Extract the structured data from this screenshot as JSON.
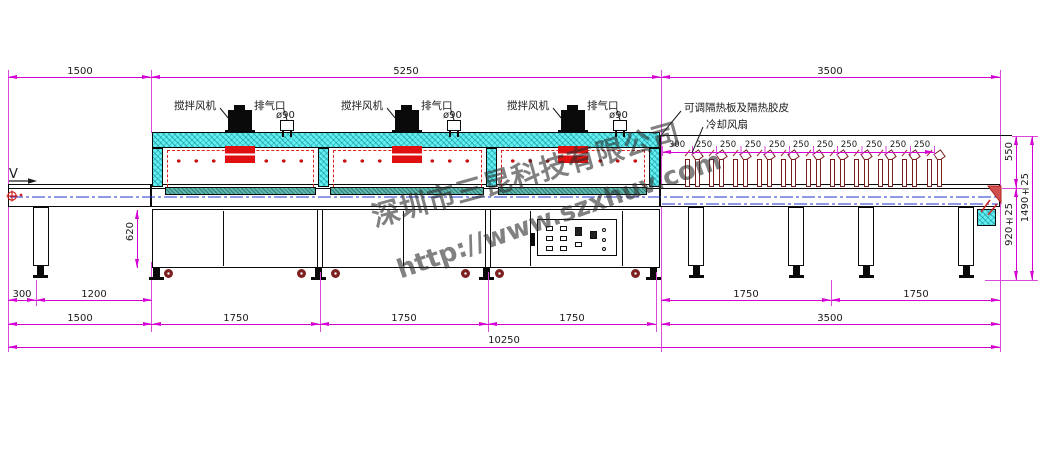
{
  "watermark": {
    "company": "深圳市三昆科技有限公司",
    "url": "http://www.szxhuv.com"
  },
  "labels": {
    "mixing_fan": "搅拌风机",
    "exhaust_port": "排气口",
    "exhaust_diameter": "ø90",
    "insulation": "可调隔热板及隔热胶皮",
    "cooling_fan": "冷却风扇",
    "direction": "V"
  },
  "dimensions": {
    "top": {
      "infeed": "1500",
      "oven": "5250",
      "cooling": "3500"
    },
    "fan_pitch": [
      "300",
      "250",
      "250",
      "250",
      "250",
      "250",
      "250",
      "250",
      "250",
      "250",
      "250"
    ],
    "right": {
      "fan_height": "550",
      "belt_height": "920±25",
      "total_height": "1490±25"
    },
    "left_stand_height": "620",
    "bottom_row1": {
      "left1": "300",
      "left2": "1200",
      "right1": "1750",
      "right2": "1750"
    },
    "bottom_row2": {
      "infeed": "1500",
      "oven1": "1750",
      "oven2": "1750",
      "oven3": "1750",
      "cooling": "3500"
    },
    "total_length": "10250"
  },
  "colors": {
    "dimension_magenta": "#d400d4",
    "outline_black": "#0a0a0a",
    "heater_red": "#e02020",
    "oven_cyan": "#63f0f0",
    "belt_teal": "#5fb9ae",
    "centerline_blue": "#2233cc",
    "fan_dark_red": "#7a1f1f"
  }
}
